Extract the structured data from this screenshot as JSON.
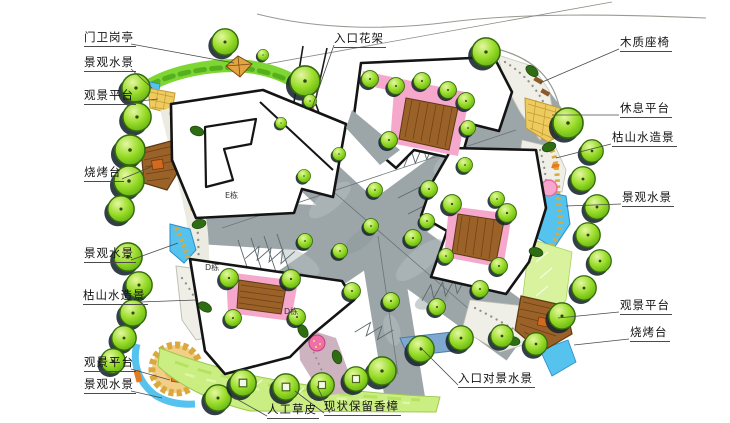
{
  "annotations": [
    {
      "text": "门卫岗亭"
    },
    {
      "text": "景观水景"
    },
    {
      "text": "观景平台"
    },
    {
      "text": "烧烤台"
    },
    {
      "text": "景观水景"
    },
    {
      "text": "枯山水造景"
    },
    {
      "text": "观景平台"
    },
    {
      "text": "景观水景"
    },
    {
      "text": "入口花架"
    },
    {
      "text": "木质座椅"
    },
    {
      "text": "休息平台"
    },
    {
      "text": "枯山水造景"
    },
    {
      "text": "景观水景"
    },
    {
      "text": "观景平台"
    },
    {
      "text": "烧烤台"
    },
    {
      "text": "入口对景水景"
    },
    {
      "text": "现状保留香樟"
    },
    {
      "text": "人工草皮"
    }
  ],
  "building_labels": [
    {
      "text": "E栋"
    },
    {
      "text": "D栋"
    },
    {
      "text": "D栋"
    }
  ],
  "palette": {
    "road": "#9CA6A9",
    "road_dark": "#5d686c",
    "building_outline": "#141414",
    "tree_green": "#97DB26",
    "tree_shadow": "#17242e",
    "water_blue": "#55C3EE",
    "flower_pink": "#F6A8CC",
    "deck_brown": "#9A6128",
    "stone_yellow": "#EDCB5F",
    "lawn_green": "#CBEE83",
    "gravel": "#EFEFE7",
    "accent_orange": "#E8821E",
    "label_color": "#141414"
  }
}
